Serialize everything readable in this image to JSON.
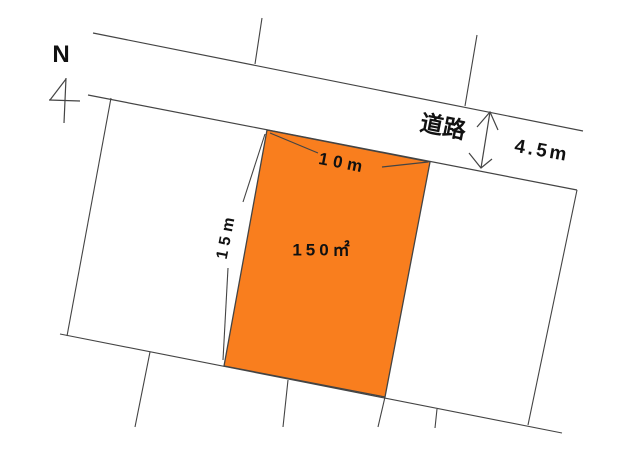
{
  "diagram": {
    "kind": "land-plot-site-plan",
    "compass": {
      "label": "N"
    },
    "road": {
      "label": "道路",
      "width_label": "4.5m"
    },
    "plot": {
      "area_label": "150㎡",
      "frontage_label": "10m",
      "depth_label": "15m"
    }
  },
  "colors": {
    "plot_fill": "#f97e1e",
    "line": "#444444",
    "text": "#111111",
    "background": "#ffffff"
  }
}
